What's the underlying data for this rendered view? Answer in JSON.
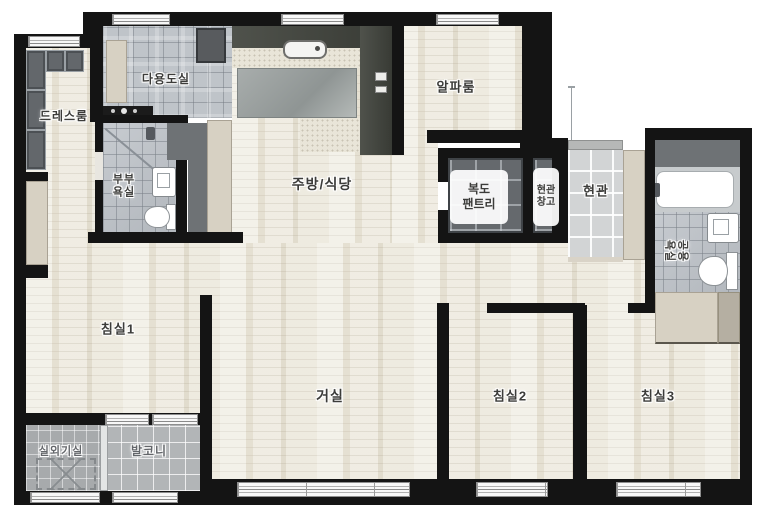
{
  "rooms": {
    "dressroom": {
      "label": "드레스룸"
    },
    "utility": {
      "label": "다용도실"
    },
    "master_bath": {
      "line1": "부부",
      "line2": "욕실"
    },
    "kitchen_dining": {
      "label": "주방/식당"
    },
    "alpha_room": {
      "label": "알파룸"
    },
    "hallway_pantry": {
      "line1": "복도",
      "line2": "팬트리"
    },
    "entry_storage": {
      "line1": "현관",
      "line2": "창고"
    },
    "entrance": {
      "label": "현관"
    },
    "common_bath": {
      "line1": "공용",
      "line2": "욕실"
    },
    "bedroom1": {
      "label": "침실1"
    },
    "living_room": {
      "label": "거실"
    },
    "bedroom2": {
      "label": "침실2"
    },
    "bedroom3": {
      "label": "침실3"
    },
    "outdoor_unit_room": {
      "label": "실외기실"
    },
    "balcony": {
      "label": "발코니"
    }
  },
  "fixtures": [
    "kitchen-sink",
    "kitchen-counter",
    "dining-table",
    "washer",
    "bathtub",
    "toilet",
    "washbasin",
    "shower",
    "wardrobe",
    "pantry-shelf",
    "shoe-cabinet",
    "ac-outdoor-unit",
    "window",
    "front-door"
  ],
  "colors": {
    "wall": "#141414",
    "wood_floor": "#ece8dc",
    "tile_floor": "#bcc1c7",
    "entry_tile": "#d2d4d5",
    "cabinet_beige": "#d7d1c3",
    "shelf_dark": "#65696d",
    "counter_charcoal": "#42453e",
    "label_text": "#3c3c3a"
  }
}
